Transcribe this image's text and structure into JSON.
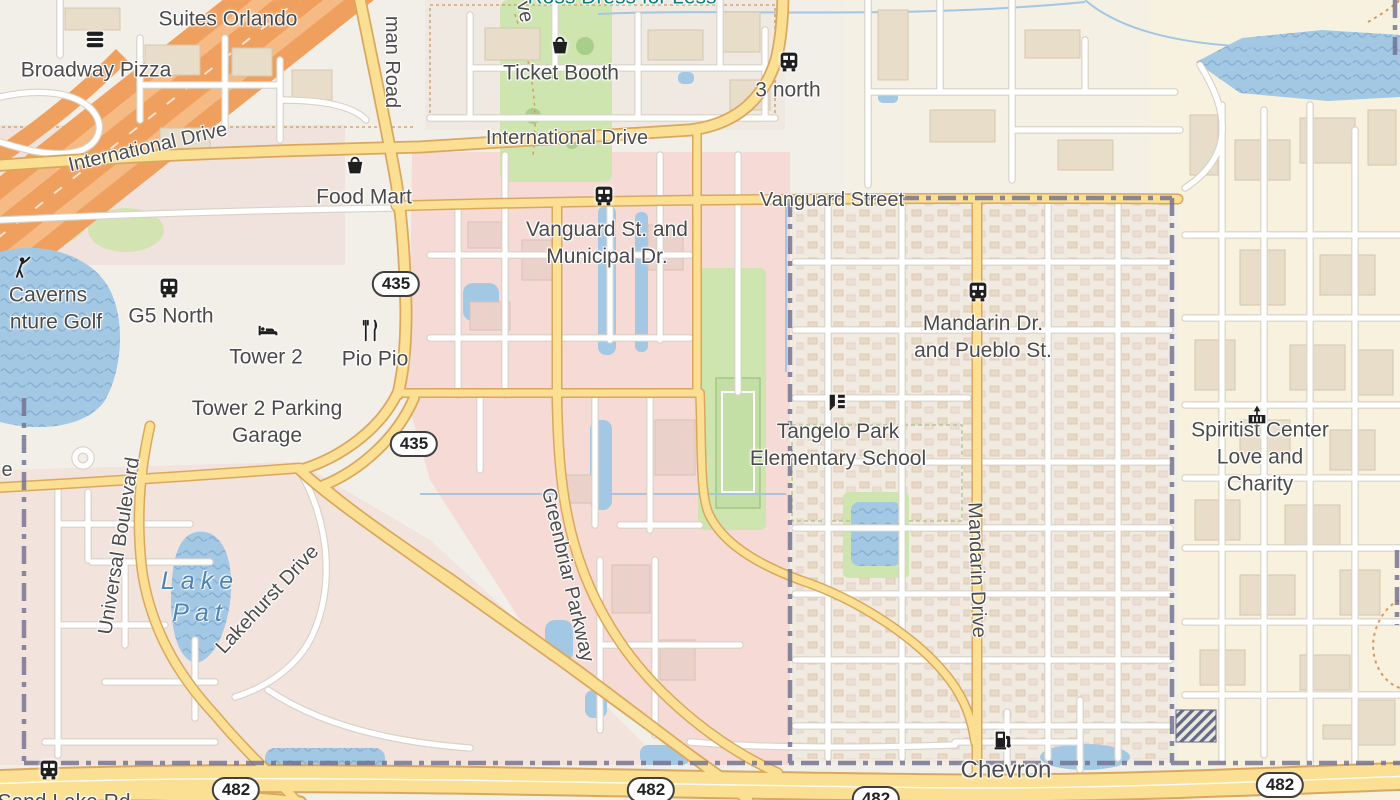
{
  "map": {
    "region": "Orlando FL – International Drive / Tangelo Park area"
  },
  "labels": {
    "homewood": "Homewood",
    "suites_orlando": "Suites Orlando",
    "ross_dress": "Ross Dress for Less",
    "broadway_pizza": "Broadway Pizza",
    "ticket_booth": "Ticket Booth",
    "three_north": "3 north",
    "international_drive": "International Drive",
    "kirkman_road_partial": "man Road",
    "ve_partial": "ve",
    "food_mart": "Food Mart",
    "vanguard_street": "Vanguard Street",
    "vanguard_municipal": "Vanguard St. and\nMunicipal Dr.",
    "g5_north": "G5 North",
    "caverns_partial": "Caverns",
    "adventure_golf_partial": "nture Golf",
    "tower2": "Tower 2",
    "pio_pio": "Pio Pio",
    "tower2_garage": "Tower 2 Parking\nGarage",
    "mandarin_pueblo": "Mandarin Dr.\nand Pueblo St.",
    "tangelo_school": "Tangelo Park\nElementary School",
    "spiritist_center": "Spiritist Center\nLove and Charity",
    "universal_boulevard": "Universal Boulevard",
    "lake_pat": "Lake\nPat",
    "lakehurst_drive": "Lakehurst Drive",
    "greenbriar_parkway": "Greenbriar Parkway",
    "mandarin_drive": "Mandarin Drive",
    "chevron": "Chevron",
    "sand_lake_partial": "Sand Lake Rd",
    "e_partial": "e"
  },
  "shields": {
    "r435": "435",
    "r482": "482"
  },
  "icons": {
    "burger": "fast-food",
    "basket": "shop",
    "bus": "bus-stop",
    "golfer": "golf-course",
    "bed": "hotel",
    "restaurant": "restaurant",
    "school": "school",
    "worship": "place-of-worship",
    "fuel": "fuel-station"
  },
  "colors": {
    "land": "#f2efe9",
    "residential_pink": "#f5dad5",
    "commercial_cream": "#f7f1de",
    "water_blue": "#a3c8e4",
    "road_yellow": "#fbdf92",
    "motorway_orange": "#f0a05e",
    "park_green": "#cfe5b0",
    "boundary_purple": "#6e6e8e",
    "shop_label_teal": "#0a7d7e"
  }
}
